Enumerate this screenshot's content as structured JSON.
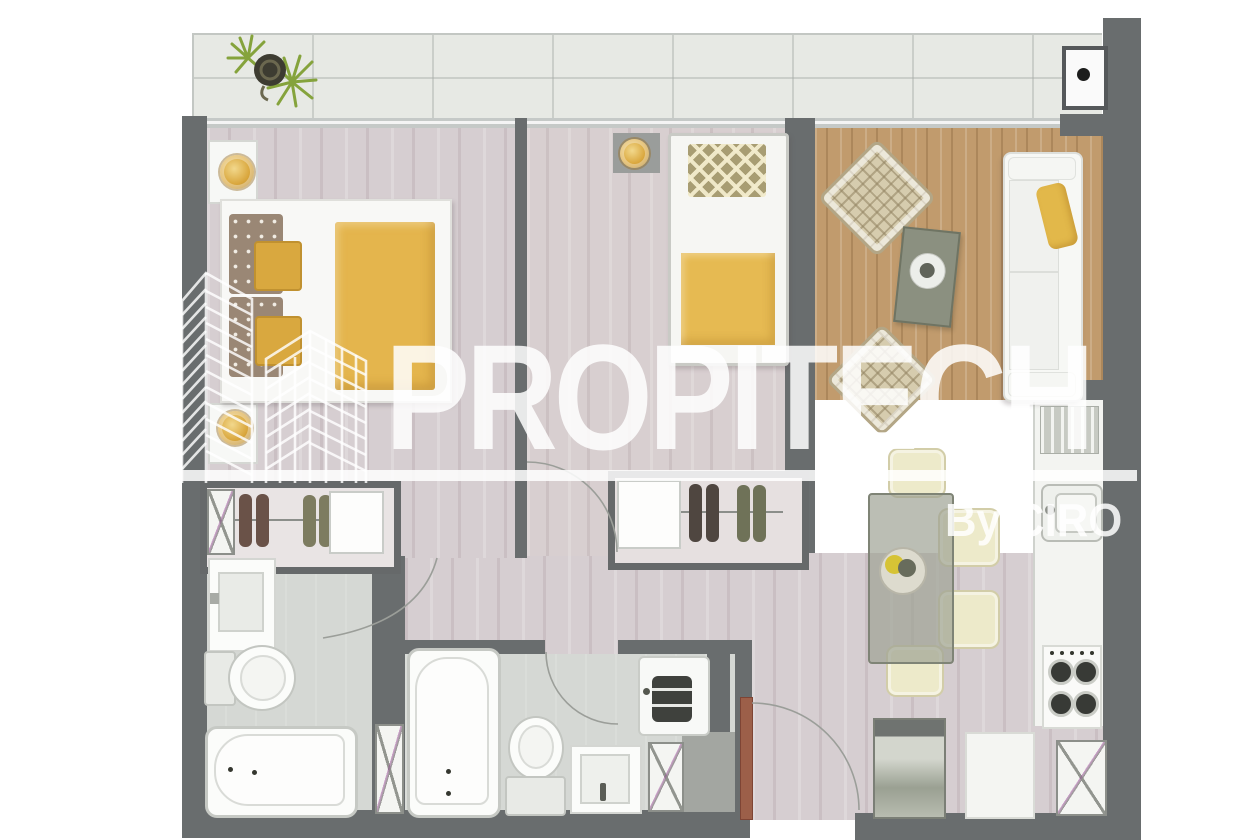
{
  "watermark": {
    "brand": "PROPITECH",
    "byline": "By CIRO",
    "logo": "buildings-outline-icon",
    "color": "#FFFFFF",
    "opacity": 0.85
  },
  "plan": {
    "type": "apartment-floor-plan-top-view",
    "rooms": [
      {
        "name": "balcony",
        "items": [
          "potted-plant",
          "wall-fixture-black-dot"
        ]
      },
      {
        "name": "bedroom-1",
        "items": [
          "double-bed-yellow-duvet",
          "dotted-pillows",
          "gold-accent-pillows",
          "nightstand-lamp-top",
          "nightstand-lamp-bottom",
          "closet-shoes-shelf"
        ]
      },
      {
        "name": "bedroom-2",
        "items": [
          "single-bed-yellow-blanket",
          "diamond-pattern-pillow",
          "wall-shelf-gold-bowl",
          "closet-shoes-shelf"
        ]
      },
      {
        "name": "living-room",
        "items": [
          "wood-area-rug",
          "rattan-armchair-north",
          "rattan-armchair-south",
          "olive-coffee-table-with-bowl",
          "white-sofa-yellow-throw"
        ]
      },
      {
        "name": "dining-area",
        "items": [
          "glass-dining-table",
          "fruit-bowl-centerpiece",
          "cream-chair-x4"
        ]
      },
      {
        "name": "kitchen",
        "items": [
          "dish-rack",
          "sink",
          "counter",
          "gas-stove-4-burners",
          "refrigerator",
          "counter-cabinet",
          "service-shaft"
        ]
      },
      {
        "name": "bathroom-1",
        "items": [
          "vanity-sink",
          "toilet",
          "bathtub-horizontal",
          "door-arc"
        ]
      },
      {
        "name": "bathroom-2",
        "items": [
          "bathtub-vertical",
          "toilet",
          "sink",
          "washing-machine",
          "service-shaft",
          "door-arc"
        ]
      },
      {
        "name": "hallway",
        "items": [
          "door-arc-bedroom-2",
          "door-arc-bathroom-1"
        ]
      },
      {
        "name": "entry",
        "items": [
          "entrance-door-brown-leaf",
          "door-swing-arc"
        ]
      }
    ]
  },
  "palette": {
    "wall": "#696d6e",
    "bedroom_floor": "#d6ced1",
    "bath_floor": "#d5d8d4",
    "balcony_floor": "#e7e9e4",
    "wood_rug": "#c19b6d",
    "accent_yellow": "#e4b54d",
    "fixture_white": "#f7f8f6",
    "entry_door": "#9c5f49",
    "plant_green": "#8aa93f"
  }
}
